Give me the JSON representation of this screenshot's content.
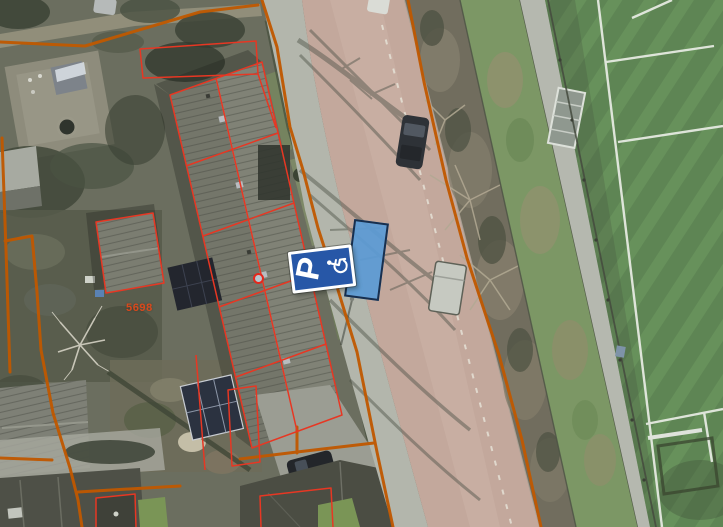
{
  "map": {
    "labels": {
      "parcel_number": "5698"
    },
    "sign": {
      "letter": "P",
      "type": "disabled-parking-sign"
    },
    "icons": {
      "wheelchair": "wheelchair-icon"
    },
    "colors": {
      "cadastral_boundary": "#c05800",
      "building_outline": "#e73723",
      "sign_blue": "#2757a7",
      "highlight_fill": "#5b9bd5",
      "highlight_stroke": "#182f4e",
      "marker_ring": "#e5281c",
      "marker_fill": "#b9c6ce",
      "parcel_label_color": "#d8491c",
      "field_green": "#5e8554",
      "road_surface": "#c3a89c"
    }
  }
}
